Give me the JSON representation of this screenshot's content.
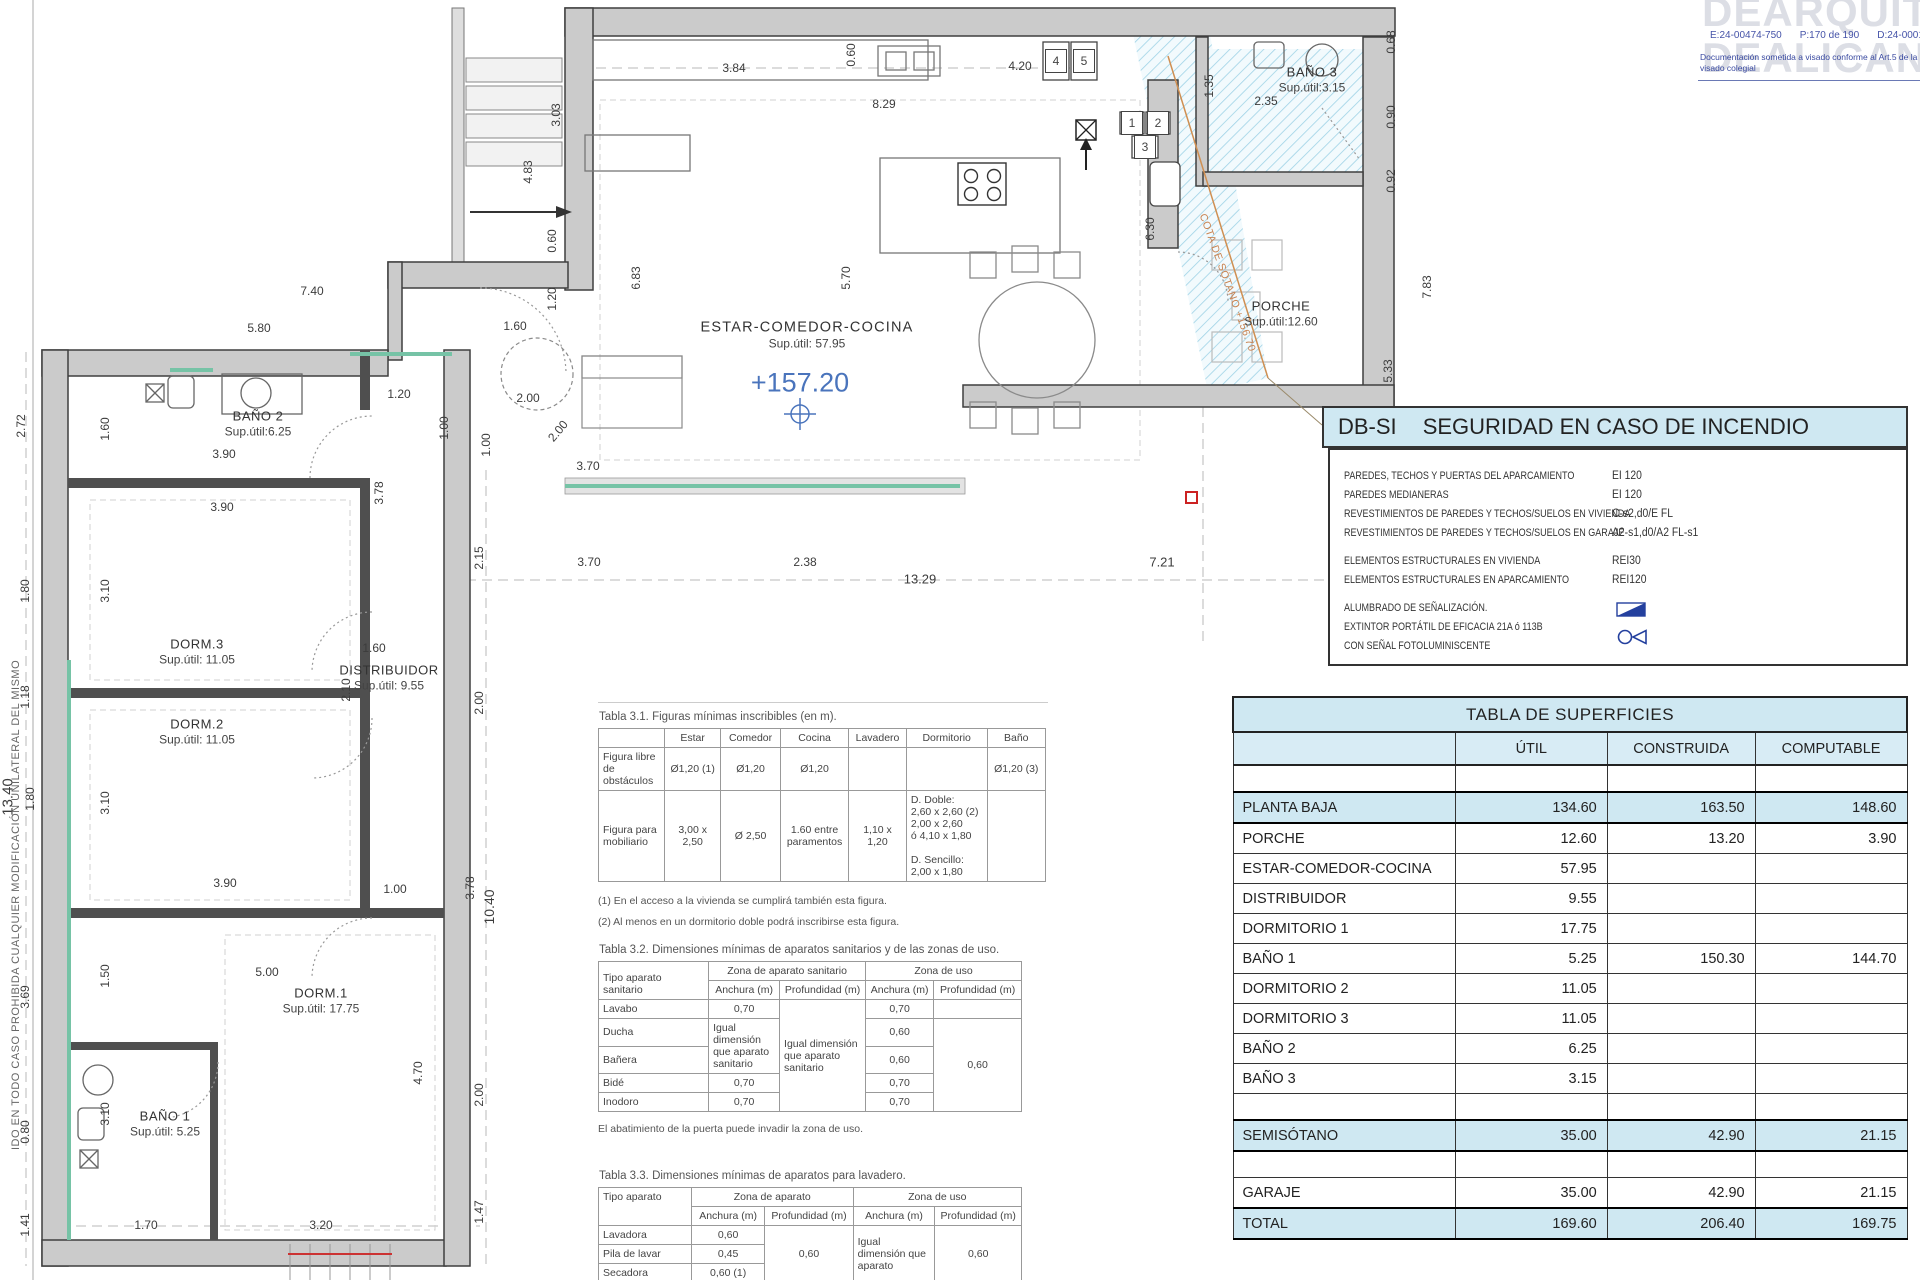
{
  "logo": {
    "line1": "DEARQUITEC",
    "line2": "DEALICANTE",
    "code_e": "E:24-00474-750",
    "code_p": "P:170 de 190",
    "code_d": "D:24-0001140",
    "note1": "Documentación sometida a visado conforme al Art.5 de la Ley 25/2009 y",
    "note2": "visado colegial"
  },
  "legal": "IDO EN TODO CASO PROHIBIDA CUALQUIER MODIFICACIÓN UNILATERAL DEL MISMO",
  "dbsi": {
    "code": "DB-SI",
    "title": "SEGURIDAD EN CASO DE INCENDIO",
    "rows": [
      {
        "label": "PAREDES, TECHOS Y PUERTAS DEL APARCAMIENTO",
        "value": "EI 120"
      },
      {
        "label": "PAREDES MEDIANERAS",
        "value": "EI 120"
      },
      {
        "label": "REVESTIMIENTOS DE PAREDES Y TECHOS/SUELOS EN VIVIENDA",
        "value": "C-s2,d0/E  FL"
      },
      {
        "label": "REVESTIMIENTOS DE PAREDES Y TECHOS/SUELOS EN GARAJE",
        "value": "A2-s1,d0/A2 FL-s1"
      },
      {
        "label": "ELEMENTOS ESTRUCTURALES EN VIVIENDA",
        "value": "REI30"
      },
      {
        "label": "ELEMENTOS ESTRUCTURALES EN APARCAMIENTO",
        "value": "REI120"
      }
    ],
    "light_label": "ALUMBRADO DE SEÑALIZACIÓN.",
    "ext_label1": "EXTINTOR PORTÁTIL DE EFICACIA 21A ó 113B",
    "ext_label2": "CON SEÑAL FOTOLUMINISCENTE"
  },
  "surfaces": {
    "title": "TABLA DE SUPERFICIES",
    "cols": [
      "ÚTIL",
      "CONSTRUIDA",
      "COMPUTABLE"
    ],
    "rows": [
      {
        "label": "",
        "util": "",
        "cons": "",
        "comp": "",
        "style": "sp"
      },
      {
        "label": "PLANTA  BAJA",
        "util": "134.60",
        "cons": "163.50",
        "comp": "148.60",
        "style": "hl"
      },
      {
        "label": "PORCHE",
        "util": "12.60",
        "cons": "13.20",
        "comp": "3.90",
        "style": ""
      },
      {
        "label": "ESTAR-COMEDOR-COCINA",
        "util": "57.95",
        "cons": "",
        "comp": "",
        "style": ""
      },
      {
        "label": "DISTRIBUIDOR",
        "util": "9.55",
        "cons": "",
        "comp": "",
        "style": ""
      },
      {
        "label": "DORMITORIO 1",
        "util": "17.75",
        "cons": "",
        "comp": "",
        "style": ""
      },
      {
        "label": "BAÑO 1",
        "util": "5.25",
        "cons": "150.30",
        "comp": "144.70",
        "style": ""
      },
      {
        "label": "DORMITORIO 2",
        "util": "11.05",
        "cons": "",
        "comp": "",
        "style": ""
      },
      {
        "label": "DORMITORIO 3",
        "util": "11.05",
        "cons": "",
        "comp": "",
        "style": ""
      },
      {
        "label": "BAÑO 2",
        "util": "6.25",
        "cons": "",
        "comp": "",
        "style": ""
      },
      {
        "label": "BAÑO 3",
        "util": "3.15",
        "cons": "",
        "comp": "",
        "style": ""
      },
      {
        "label": "",
        "util": "",
        "cons": "",
        "comp": "",
        "style": "sp"
      },
      {
        "label": "SEMISÓTANO",
        "util": "35.00",
        "cons": "42.90",
        "comp": "21.15",
        "style": "hl"
      },
      {
        "label": "",
        "util": "",
        "cons": "",
        "comp": "",
        "style": "sp"
      },
      {
        "label": "GARAJE",
        "util": "35.00",
        "cons": "42.90",
        "comp": "21.15",
        "style": ""
      },
      {
        "label": "TOTAL",
        "util": "169.60",
        "cons": "206.40",
        "comp": "169.75",
        "style": "hl"
      }
    ]
  },
  "tabla31": {
    "title": "Tabla 3.1. Figuras mínimas inscribibles (en m).",
    "headers": [
      "Estar",
      "Comedor",
      "Cocina",
      "Lavadero",
      "Dormitorio",
      "Baño"
    ],
    "row1_label": "Figura libre de obstáculos",
    "row1": [
      "Ø1,20 (1)",
      "Ø1,20",
      "Ø1,20",
      "",
      "",
      "Ø1,20 (3)"
    ],
    "row2_label": "Figura para mobiliario",
    "row2": [
      "3,00 x 2,50",
      "Ø 2,50",
      "1.60 entre paramentos",
      "1,10 x 1,20",
      "D. Doble:\n2,60 x 2,60 (2)\n2,00 x 2,60\nó 4,10 x 1,80\n \nD. Sencillo:\n2,00 x 1,80",
      ""
    ],
    "notes": [
      "(1) En el acceso a la vivienda se cumplirá también esta figura.",
      "(2) Al menos en un dormitorio doble podrá inscribirse esta figura."
    ]
  },
  "tabla32": {
    "title": "Tabla 3.2. Dimensiones mínimas de aparatos sanitarios y de las zonas de uso.",
    "col0": "Tipo aparato sanitario",
    "group1": "Zona de aparato sanitario",
    "group2": "Zona de uso",
    "anchura": "Anchura (m)",
    "profundidad": "Profundidad (m)",
    "igual": "Igual dimensión que aparato sanitario",
    "rows": {
      "lavabo": "Lavabo",
      "ducha": "Ducha",
      "banera": "Bañera",
      "bide": "Bidé",
      "inodoro": "Inodoro"
    },
    "v": {
      "lavabo_a": "0,70",
      "bide_a": "0,70",
      "inodoro_a": "0,70",
      "lavabo_ua": "0,70",
      "ducha_ua": "0,60",
      "banera_ua": "0,60",
      "bide_ua": "0,70",
      "inodoro_ua": "0,70",
      "uso_prof": "0,60"
    },
    "note": "El abatimiento de la puerta puede invadir la zona de uso."
  },
  "tabla33": {
    "title": "Tabla 3.3. Dimensiones mínimas de aparatos para lavadero.",
    "col0": "Tipo aparato",
    "group1": "Zona de aparato",
    "group2": "Zona de uso",
    "anchura": "Anchura (m)",
    "profundidad": "Profundidad (m)",
    "rows": {
      "lavadora": "Lavadora",
      "pila": "Pila de lavar",
      "secadora": "Secadora"
    },
    "v": {
      "lavadora_a": "0,60",
      "pila_a": "0,45",
      "secadora_a": "0,60 (1)",
      "prof": "0,60",
      "uso_a": "Igual dimensión que aparato",
      "uso_p": "0,60"
    }
  },
  "plan": {
    "level": "+157.20",
    "cota": "COTA DE SÓTANO +156.70",
    "rooms": [
      {
        "name": "BAÑO 2",
        "sup": "Sup.útil:6.25",
        "x": 258,
        "y": 424
      },
      {
        "name": "DORM.3",
        "sup": "Sup.útil: 11.05",
        "x": 197,
        "y": 652
      },
      {
        "name": "DISTRIBUIDOR",
        "sup": "Sup.útil: 9.55",
        "x": 389,
        "y": 678
      },
      {
        "name": "DORM.2",
        "sup": "Sup.útil: 11.05",
        "x": 197,
        "y": 732
      },
      {
        "name": "DORM.1",
        "sup": "Sup.útil: 17.75",
        "x": 321,
        "y": 1001
      },
      {
        "name": "BAÑO 1",
        "sup": "Sup.útil: 5.25",
        "x": 165,
        "y": 1124
      },
      {
        "name": "ESTAR-COMEDOR-COCINA",
        "sup": "Sup.útil: 57.95",
        "x": 807,
        "y": 335,
        "big": true
      },
      {
        "name": "BAÑO 3",
        "sup": "Sup.útil:3.15",
        "x": 1312,
        "y": 80
      },
      {
        "name": "PORCHE",
        "sup": "Sup.útil:12.60",
        "x": 1281,
        "y": 314
      }
    ],
    "tags": [
      {
        "t": "4",
        "x": 1056,
        "y": 61
      },
      {
        "t": "5",
        "x": 1084,
        "y": 61
      },
      {
        "t": "1",
        "x": 1132,
        "y": 123
      },
      {
        "t": "2",
        "x": 1158,
        "y": 123
      },
      {
        "t": "3",
        "x": 1145,
        "y": 147
      }
    ],
    "dims": [
      {
        "t": "3.84",
        "x": 734,
        "y": 68
      },
      {
        "t": "0.60",
        "x": 851,
        "y": 55,
        "r": -90
      },
      {
        "t": "4.20",
        "x": 1020,
        "y": 66
      },
      {
        "t": "8.29",
        "x": 884,
        "y": 104
      },
      {
        "t": "3.03",
        "x": 556,
        "y": 115,
        "r": -90
      },
      {
        "t": "4.83",
        "x": 528,
        "y": 172,
        "r": -90
      },
      {
        "t": "0.60",
        "x": 552,
        "y": 241,
        "r": -90
      },
      {
        "t": "6.83",
        "x": 636,
        "y": 278,
        "r": -90
      },
      {
        "t": "5.70",
        "x": 846,
        "y": 278,
        "r": -90
      },
      {
        "t": "1.20",
        "x": 552,
        "y": 299,
        "r": -90
      },
      {
        "t": "7.40",
        "x": 312,
        "y": 291
      },
      {
        "t": "5.80",
        "x": 259,
        "y": 328
      },
      {
        "t": "1.60",
        "x": 515,
        "y": 326
      },
      {
        "t": "1.20",
        "x": 399,
        "y": 394
      },
      {
        "t": "2.00",
        "x": 528,
        "y": 398
      },
      {
        "t": "1.00",
        "x": 444,
        "y": 428,
        "r": -90
      },
      {
        "t": "1.00",
        "x": 486,
        "y": 445,
        "r": -90
      },
      {
        "t": "2.00",
        "x": 558,
        "y": 431,
        "r": -50
      },
      {
        "t": "3.70",
        "x": 588,
        "y": 466
      },
      {
        "t": "2.72",
        "x": 21,
        "y": 426,
        "r": -90
      },
      {
        "t": "1.60",
        "x": 105,
        "y": 429,
        "r": -90
      },
      {
        "t": "3.90",
        "x": 224,
        "y": 454
      },
      {
        "t": "3.90",
        "x": 222,
        "y": 507
      },
      {
        "t": "3.78",
        "x": 379,
        "y": 493,
        "r": -90
      },
      {
        "t": "2.15",
        "x": 479,
        "y": 558,
        "r": -90
      },
      {
        "t": "3.70",
        "x": 589,
        "y": 562
      },
      {
        "t": "2.38",
        "x": 805,
        "y": 562
      },
      {
        "t": "13.29",
        "x": 920,
        "y": 579,
        "s": 13
      },
      {
        "t": "7.21",
        "x": 1162,
        "y": 562,
        "s": 13
      },
      {
        "t": "1.80",
        "x": 25,
        "y": 591,
        "r": -90
      },
      {
        "t": "3.10",
        "x": 105,
        "y": 591,
        "r": -90
      },
      {
        "t": "1.18",
        "x": 25,
        "y": 697,
        "r": -90
      },
      {
        "t": "1.60",
        "x": 374,
        "y": 648
      },
      {
        "t": "2.10",
        "x": 346,
        "y": 690,
        "r": -90
      },
      {
        "t": "2.00",
        "x": 479,
        "y": 703,
        "r": -90
      },
      {
        "t": "13.40",
        "x": 8,
        "y": 797,
        "r": -90,
        "s": 15
      },
      {
        "t": "1.80",
        "x": 30,
        "y": 799,
        "r": -90
      },
      {
        "t": "3.10",
        "x": 105,
        "y": 803,
        "r": -90
      },
      {
        "t": "3.90",
        "x": 225,
        "y": 883
      },
      {
        "t": "1.00",
        "x": 395,
        "y": 889
      },
      {
        "t": "3.78",
        "x": 470,
        "y": 888,
        "r": -90
      },
      {
        "t": "10.40",
        "x": 489,
        "y": 907,
        "r": -90,
        "s": 14
      },
      {
        "t": "3.69",
        "x": 25,
        "y": 997,
        "r": -90
      },
      {
        "t": "5.00",
        "x": 267,
        "y": 972
      },
      {
        "t": "1.50",
        "x": 105,
        "y": 976,
        "r": -90
      },
      {
        "t": "4.70",
        "x": 418,
        "y": 1073,
        "r": -90
      },
      {
        "t": "2.00",
        "x": 479,
        "y": 1095,
        "r": -90
      },
      {
        "t": "0.80",
        "x": 25,
        "y": 1132,
        "r": -90
      },
      {
        "t": "3.10",
        "x": 105,
        "y": 1114,
        "r": -90
      },
      {
        "t": "1.70",
        "x": 146,
        "y": 1225
      },
      {
        "t": "3.20",
        "x": 321,
        "y": 1225
      },
      {
        "t": "1.47",
        "x": 479,
        "y": 1212,
        "r": -90
      },
      {
        "t": "1.41",
        "x": 25,
        "y": 1225,
        "r": -90
      },
      {
        "t": "0.68",
        "x": 1391,
        "y": 42,
        "r": -90
      },
      {
        "t": "0.90",
        "x": 1391,
        "y": 117,
        "r": -90
      },
      {
        "t": "0.92",
        "x": 1391,
        "y": 181,
        "r": -90
      },
      {
        "t": "1.35",
        "x": 1209,
        "y": 86,
        "r": -90
      },
      {
        "t": "2.35",
        "x": 1266,
        "y": 101
      },
      {
        "t": "6.30",
        "x": 1150,
        "y": 229,
        "r": -90
      },
      {
        "t": "7.83",
        "x": 1427,
        "y": 287,
        "r": -90
      },
      {
        "t": "5.33",
        "x": 1388,
        "y": 371,
        "r": -90
      }
    ]
  }
}
